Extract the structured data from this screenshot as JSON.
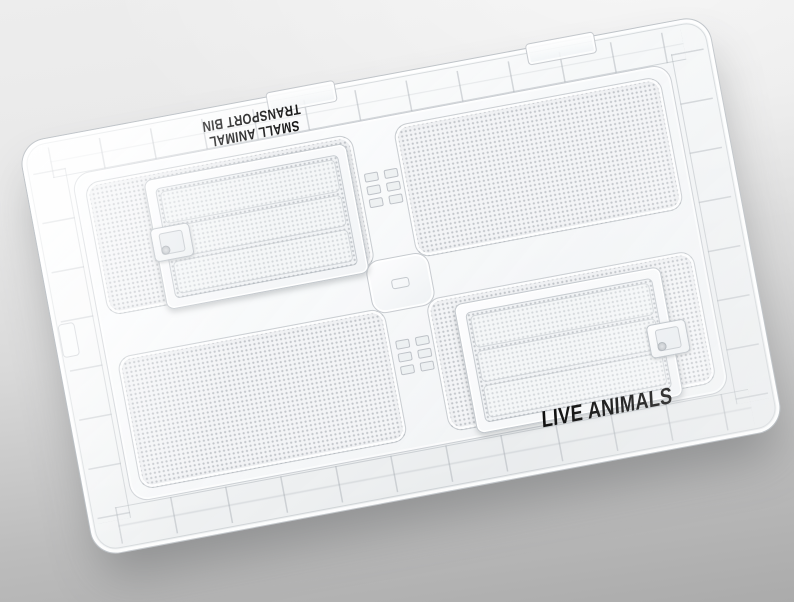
{
  "product_labels": {
    "top_line1": "SMALL ANIMAL",
    "top_line2": "TRANSPORT BIN",
    "bottom": "LIVE ANIMALS"
  },
  "colors": {
    "background_top": "#ededed",
    "background_bottom": "#ababab",
    "label_text": "#0b0b0b",
    "plastic_edge_line": "#969da4",
    "plastic_fill": "#f3f4f6",
    "door_frame": "#fbfcfd",
    "mesh_dot": "#929aa0"
  }
}
